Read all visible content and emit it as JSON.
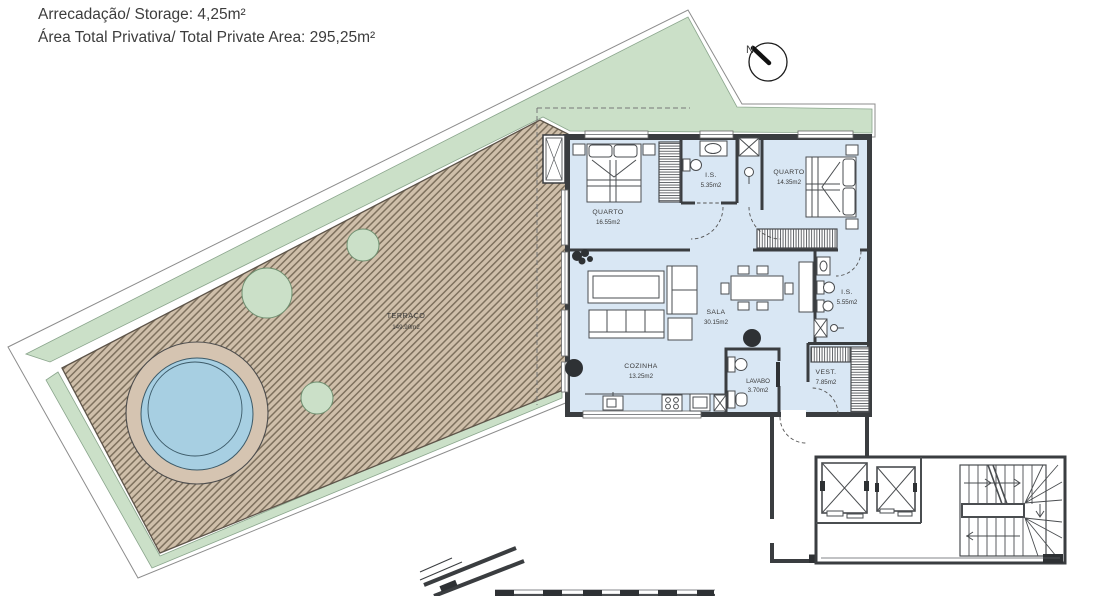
{
  "header": {
    "line1": "Arrecadação/ Storage: 4,25m²",
    "line2": "Área Total Privativa/ Total Private Area: 295,25m²"
  },
  "compass": {
    "label": "N"
  },
  "rooms": [
    {
      "name": "TERRAÇO",
      "area": "149.90m2"
    },
    {
      "name": "QUARTO",
      "area": "16.55m2"
    },
    {
      "name": "I.S.",
      "area": "5.35m2"
    },
    {
      "name": "QUARTO",
      "area": "14.35m2"
    },
    {
      "name": "SALA",
      "area": "30.15m2"
    },
    {
      "name": "I.S.",
      "area": "5.55m2"
    },
    {
      "name": "COZINHA",
      "area": "13.25m2"
    },
    {
      "name": "LAVABO",
      "area": "3.70m2"
    },
    {
      "name": "VEST.",
      "area": "7.85m2"
    }
  ],
  "colors": {
    "green": "#cbe0c8",
    "terrace_deck": "#cfbfaa",
    "deck_line": "#7e715e",
    "pool_deck": "#d5c4b1",
    "pool_water": "#a7cfe2",
    "floor": "#d9e7f4",
    "wall": "#3a3d40"
  }
}
